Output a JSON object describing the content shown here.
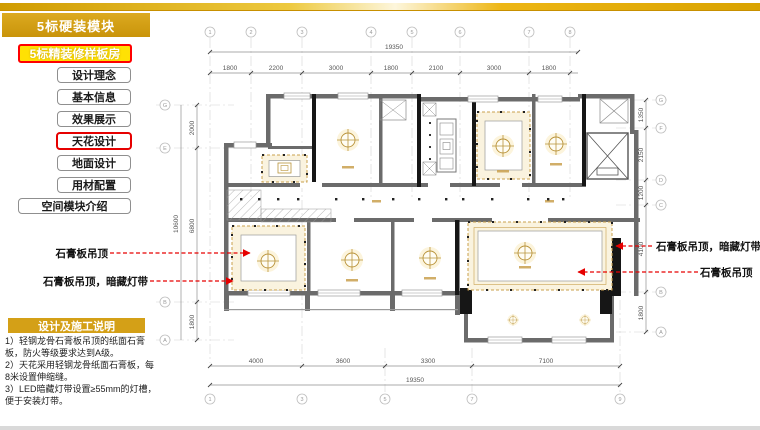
{
  "sidebar": {
    "module_title": "5标硬装模块",
    "submodule_title": "5标精装修样板房",
    "menu_items": [
      {
        "label": "设计理念",
        "active": false
      },
      {
        "label": "基本信息",
        "active": false
      },
      {
        "label": "效果展示",
        "active": false
      },
      {
        "label": "天花设计",
        "active": true
      },
      {
        "label": "地面设计",
        "active": false
      },
      {
        "label": "用材配置",
        "active": false
      }
    ],
    "wide_item": "空间模块介绍"
  },
  "notes": {
    "title": "设计及施工说明",
    "items": [
      "1）轻钢龙骨石膏板吊顶的纸面石膏板，防火等级要求达到A级。",
      "2）天花采用轻钢龙骨纸面石膏板，每8米设置伸缩缝。",
      "3）LED暗藏灯带设置≥55mm的灯槽，便于安装灯带。"
    ]
  },
  "annotations": {
    "left": [
      "石膏板吊顶",
      "石膏板吊顶，暗藏灯带"
    ],
    "right": [
      "石膏板吊顶，暗藏灯带",
      "石膏板吊顶"
    ]
  },
  "plan": {
    "dims_top": {
      "overall": "19350",
      "segments": [
        "1800",
        "2200",
        "3000",
        "1800",
        "2100",
        "3000",
        "1800"
      ]
    },
    "dims_bottom": {
      "overall": "19350",
      "segments": [
        "4000",
        "3600",
        "3300",
        "7100"
      ]
    },
    "dims_left": {
      "overall": "10600",
      "segments": [
        "2000",
        "6800",
        "1800"
      ]
    },
    "dims_right": {
      "segments": [
        "1350",
        "2150",
        "1200",
        "4100",
        "1800"
      ]
    },
    "grid_top": [
      "1",
      "2",
      "3",
      "4",
      "5",
      "6",
      "7",
      "8"
    ],
    "grid_bottom": [
      "1",
      "3",
      "5",
      "7",
      "9"
    ],
    "grid_left": [
      "G",
      "E",
      "B",
      "A"
    ],
    "grid_right": [
      "G",
      "F",
      "D",
      "C",
      "B",
      "A"
    ]
  },
  "colors": {
    "accent_gold": "#d4a017",
    "highlight_yellow": "#ffe104",
    "alert_red": "#e60000",
    "tray_border_gold": "#c9a04e",
    "tray_fill": "#faf3df"
  }
}
